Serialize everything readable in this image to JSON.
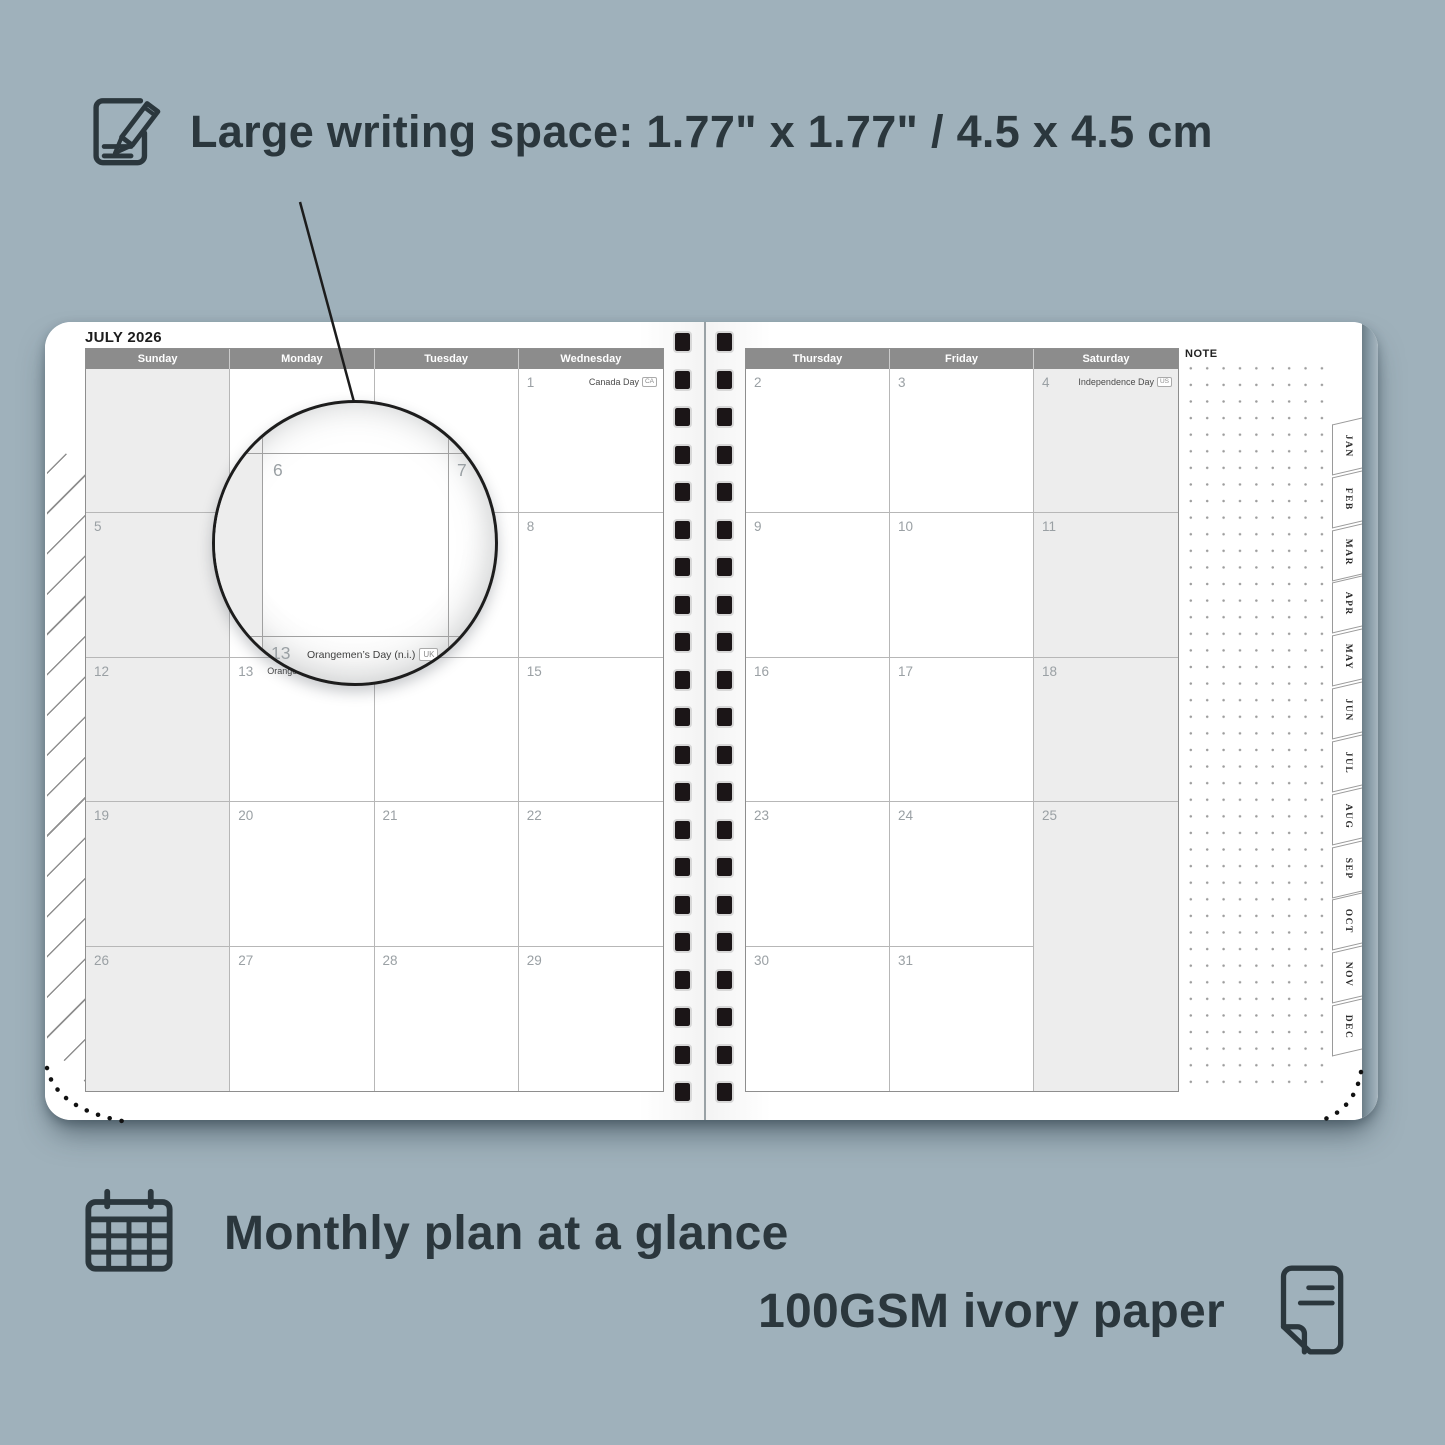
{
  "annotations": {
    "writing_space": "Large writing space: 1.77\" x 1.77\" / 4.5 x 4.5 cm",
    "monthly": "Monthly plan at a glance",
    "paper": "100GSM ivory paper"
  },
  "calendar": {
    "title": "JULY 2026",
    "note_label": "NOTE",
    "left_headers": [
      "Sunday",
      "Monday",
      "Tuesday",
      "Wednesday"
    ],
    "right_headers": [
      "Thursday",
      "Friday",
      "Saturday"
    ],
    "left_cells": [
      {
        "day": "",
        "wk": 1
      },
      {
        "day": ""
      },
      {
        "day": ""
      },
      {
        "day": "1",
        "holiday": "Canada Day",
        "badge": "CA"
      },
      {
        "day": "5",
        "wk": 1
      },
      {
        "day": "6"
      },
      {
        "day": "7"
      },
      {
        "day": "8"
      },
      {
        "day": "12",
        "wk": 1
      },
      {
        "day": "13",
        "holiday": "Orangemen’s Day (n.i.)",
        "badge": "UK",
        "inline": 1
      },
      {
        "day": "14"
      },
      {
        "day": "15"
      },
      {
        "day": "19",
        "wk": 1
      },
      {
        "day": "20"
      },
      {
        "day": "21"
      },
      {
        "day": "22"
      },
      {
        "day": "26",
        "wk": 1
      },
      {
        "day": "27"
      },
      {
        "day": "28"
      },
      {
        "day": "29"
      }
    ],
    "right_cells": [
      {
        "day": "2"
      },
      {
        "day": "3"
      },
      {
        "day": "4",
        "holiday": "Independence Day",
        "badge": "US",
        "wk": 1
      },
      {
        "day": "9"
      },
      {
        "day": "10"
      },
      {
        "day": "11",
        "wk": 1
      },
      {
        "day": "16"
      },
      {
        "day": "17"
      },
      {
        "day": "18",
        "wk": 1
      },
      {
        "day": "23"
      },
      {
        "day": "24"
      },
      {
        "day": "25",
        "wk": 1
      },
      {
        "day": "30"
      },
      {
        "day": "31"
      },
      {
        "day": "",
        "wk": 1
      }
    ],
    "tabs": [
      "JAN",
      "FEB",
      "MAR",
      "APR",
      "MAY",
      "JUN",
      "JUL",
      "AUG",
      "SEP",
      "OCT",
      "NOV",
      "DEC"
    ]
  },
  "magnifier": {
    "top_left_day": "6",
    "top_right_day": "7",
    "bottom_day": "13",
    "holiday": "Orangemen’s Day (n.i.)",
    "badge": "UK"
  },
  "colors": {
    "background": "#9fb1bb",
    "ink": "#2b373d",
    "header-bar": "#8c8c8c",
    "weekend": "#ededed",
    "binding": "#1b1517"
  }
}
